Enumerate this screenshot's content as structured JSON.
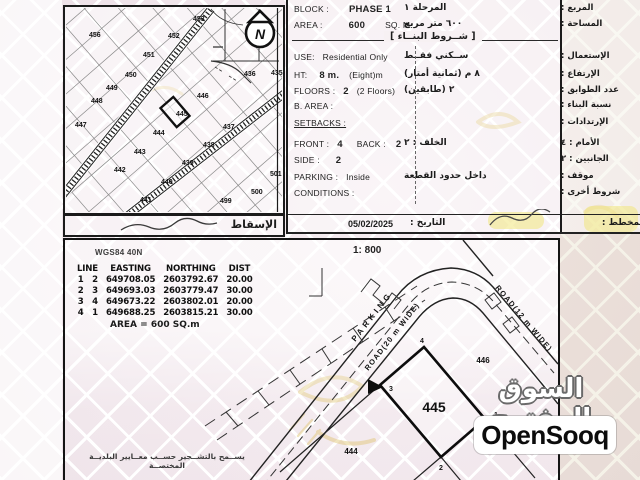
{
  "watermark": {
    "arabic": "السوق المفتوح",
    "latin": "OpenSooq"
  },
  "top_map": {
    "compass": "N",
    "projection_label": "الإسقاط",
    "plots": [
      {
        "n": "456",
        "x": 24,
        "y": 30
      },
      {
        "n": "453",
        "x": 128,
        "y": 14
      },
      {
        "n": "452",
        "x": 103,
        "y": 31
      },
      {
        "n": "451",
        "x": 78,
        "y": 50
      },
      {
        "n": "450",
        "x": 60,
        "y": 70
      },
      {
        "n": "449",
        "x": 41,
        "y": 83
      },
      {
        "n": "448",
        "x": 26,
        "y": 96
      },
      {
        "n": "447",
        "x": 10,
        "y": 120
      },
      {
        "n": "446",
        "x": 132,
        "y": 91
      },
      {
        "n": "445",
        "x": 111,
        "y": 109,
        "bold": true
      },
      {
        "n": "444",
        "x": 88,
        "y": 128
      },
      {
        "n": "443",
        "x": 69,
        "y": 147
      },
      {
        "n": "442",
        "x": 49,
        "y": 165
      },
      {
        "n": "441",
        "x": 75,
        "y": 195
      },
      {
        "n": "440",
        "x": 96,
        "y": 177
      },
      {
        "n": "439",
        "x": 117,
        "y": 158
      },
      {
        "n": "438",
        "x": 138,
        "y": 140
      },
      {
        "n": "437",
        "x": 158,
        "y": 122
      },
      {
        "n": "436",
        "x": 179,
        "y": 69
      },
      {
        "n": "435",
        "x": 206,
        "y": 68
      },
      {
        "n": "501",
        "x": 205,
        "y": 169
      },
      {
        "n": "500",
        "x": 186,
        "y": 187
      },
      {
        "n": "499",
        "x": 155,
        "y": 196
      }
    ]
  },
  "info": {
    "rows": [
      {
        "y": 4,
        "en": [
          {
            "t": "BLOCK :"
          },
          {
            "t": "PHASE 1",
            "b": 1,
            "ml": 20
          }
        ],
        "ar_v": "المرحلة ١",
        "ar_l": "المربع :"
      },
      {
        "y": 20,
        "en": [
          {
            "t": "AREA :"
          },
          {
            "t": "600",
            "b": 1,
            "ml": 26
          },
          {
            "t": "SQ. M.",
            "ml": 20
          }
        ],
        "ar_v": "٦٠٠ متر مربع",
        "ar_l": "المساحة :"
      },
      {
        "y": 52,
        "en": [
          {
            "t": "USE:"
          },
          {
            "t": "Residential Only",
            "ml": 8
          }
        ],
        "ar_v": "ســكني فقــط",
        "ar_l": "الإستعمال :"
      },
      {
        "y": 70,
        "en": [
          {
            "t": "HT:"
          },
          {
            "t": "8 m.",
            "b": 1,
            "ml": 12
          },
          {
            "t": "(Eight)m",
            "ml": 10
          }
        ],
        "ar_v": "٨ م (ثمانية أمتار)",
        "ar_l": "الإرتفاع :"
      },
      {
        "y": 86,
        "en": [
          {
            "t": "FLOORS :"
          },
          {
            "t": "2",
            "b": 1,
            "ml": 8
          },
          {
            "t": "(2 Floors)",
            "ml": 8
          }
        ],
        "ar_v": "٢ (طابقين)",
        "ar_l": "عدد الطوابق :"
      },
      {
        "y": 101,
        "en": [
          {
            "t": "B. AREA :"
          }
        ],
        "ar_v": "",
        "ar_l": "نسبة البناء :"
      },
      {
        "y": 118,
        "en": [
          {
            "t": "SETBACKS :",
            "u": 1
          }
        ],
        "ar_v": "",
        "ar_l": "الإرتدادات :"
      },
      {
        "y": 139,
        "en": [
          {
            "t": "FRONT :"
          },
          {
            "t": "4",
            "b": 1,
            "ml": 8
          },
          {
            "t": "BACK :",
            "ml": 14
          },
          {
            "t": "2",
            "b": 1,
            "ml": 10
          }
        ],
        "ar_v": "الخلف : ٢",
        "ar_l": "الأمام : ٤"
      },
      {
        "y": 155,
        "en": [
          {
            "t": "SIDE :"
          },
          {
            "t": "2",
            "b": 1,
            "ml": 16
          }
        ],
        "ar_v": "",
        "ar_l": "الجانبين : ٢"
      },
      {
        "y": 172,
        "en": [
          {
            "t": "PARKING :"
          },
          {
            "t": "Inside",
            "ml": 8
          }
        ],
        "ar_v": "داخل حدود القطعة",
        "ar_l": "موقف :"
      },
      {
        "y": 188,
        "en": [
          {
            "t": "CONDITIONS :"
          }
        ],
        "ar_v": "",
        "ar_l": "شروط أخرى :"
      }
    ],
    "separator": "[ شــروط البنــاء ]",
    "date_value": "05/02/2025",
    "date_label": "التاريخ :",
    "planner_label": "المخطط :"
  },
  "survey": {
    "datum": "WGS84 40N",
    "scale": "1: 800",
    "table": {
      "line_header": "LINE",
      "headers": [
        "EASTING",
        "NORTHING",
        "DIST"
      ],
      "rows": [
        [
          "1",
          "2",
          "649708.05",
          "2603792.67",
          "20.00"
        ],
        [
          "2",
          "3",
          "649693.03",
          "2603779.47",
          "30.00"
        ],
        [
          "3",
          "4",
          "649673.22",
          "2603802.01",
          "20.00"
        ],
        [
          "4",
          "1",
          "649688.25",
          "2603815.21",
          "30.00"
        ]
      ]
    },
    "area_note": "AREA = 600  SQ.m",
    "note_ar": "يســمح بالتشــجير حســب معــايير البلديــة المختصــة",
    "plan": {
      "road_labels": [
        {
          "t": "PARKING",
          "x": 309,
          "y": 78,
          "rot": -52,
          "size": 8,
          "ls": 3.5
        },
        {
          "t": "ROAD(20 m WIDE)",
          "x": 329,
          "y": 98,
          "rot": -52,
          "size": 7.5,
          "ls": 1.2
        },
        {
          "t": "ROAD(12 m WIDE)",
          "x": 457,
          "y": 80,
          "rot": 50,
          "size": 7.5,
          "ls": 1.2
        }
      ],
      "plot_labels": [
        {
          "t": "445",
          "x": 369,
          "y": 172,
          "size": 14
        },
        {
          "t": "446",
          "x": 418,
          "y": 123,
          "size": 8
        },
        {
          "t": "444",
          "x": 286,
          "y": 214,
          "size": 8
        }
      ],
      "corners": [
        {
          "t": "4",
          "x": 355,
          "y": 103
        },
        {
          "t": "3",
          "x": 324,
          "y": 151
        },
        {
          "t": "2",
          "x": 374,
          "y": 230
        },
        {
          "t": "1",
          "x": 429,
          "y": 177
        }
      ]
    }
  },
  "colors": {
    "ink": "#1b1b1b",
    "highlight": "#f1e57b",
    "gold": "#d9b953",
    "paper_pink": "#efe3e9"
  }
}
